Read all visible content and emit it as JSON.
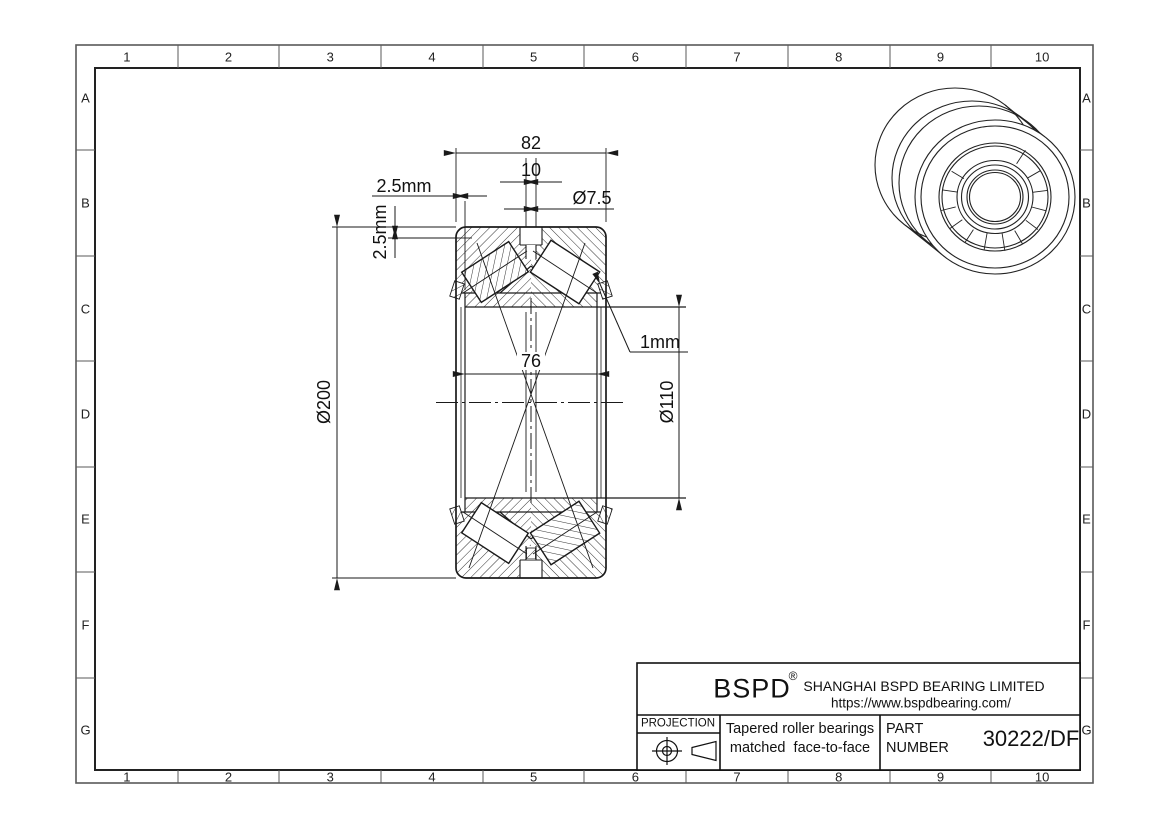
{
  "sheet": {
    "cols": [
      "1",
      "2",
      "3",
      "4",
      "5",
      "6",
      "7",
      "8",
      "9",
      "10"
    ],
    "rows": [
      "A",
      "B",
      "C",
      "D",
      "E",
      "F",
      "G"
    ]
  },
  "drawing": {
    "dim_outer_width": "82",
    "dim_groove_width": "10",
    "dim_hole_dia": "Ø7.5",
    "dim_face_offset": "2.5mm",
    "dim_od_step": "2.5mm",
    "dim_outer_dia": "Ø200",
    "dim_inner_width": "76",
    "dim_ring_gap": "1mm",
    "dim_bore_dia": "Ø110"
  },
  "title_block": {
    "brand": "BSPD",
    "reg_mark": "®",
    "company": "SHANGHAI BSPD BEARING LIMITED",
    "website": "https://www.bspdbearing.com/",
    "projection_label": "PROJECTION",
    "description_line1": "Tapered roller bearings",
    "description_line2": "matched  face-to-face",
    "part_label_line1": "PART",
    "part_label_line2": "NUMBER",
    "part_number": "30222/DF"
  },
  "colors": {
    "line": "#1a1a1a",
    "frame": "#595959",
    "text": "#111111"
  }
}
